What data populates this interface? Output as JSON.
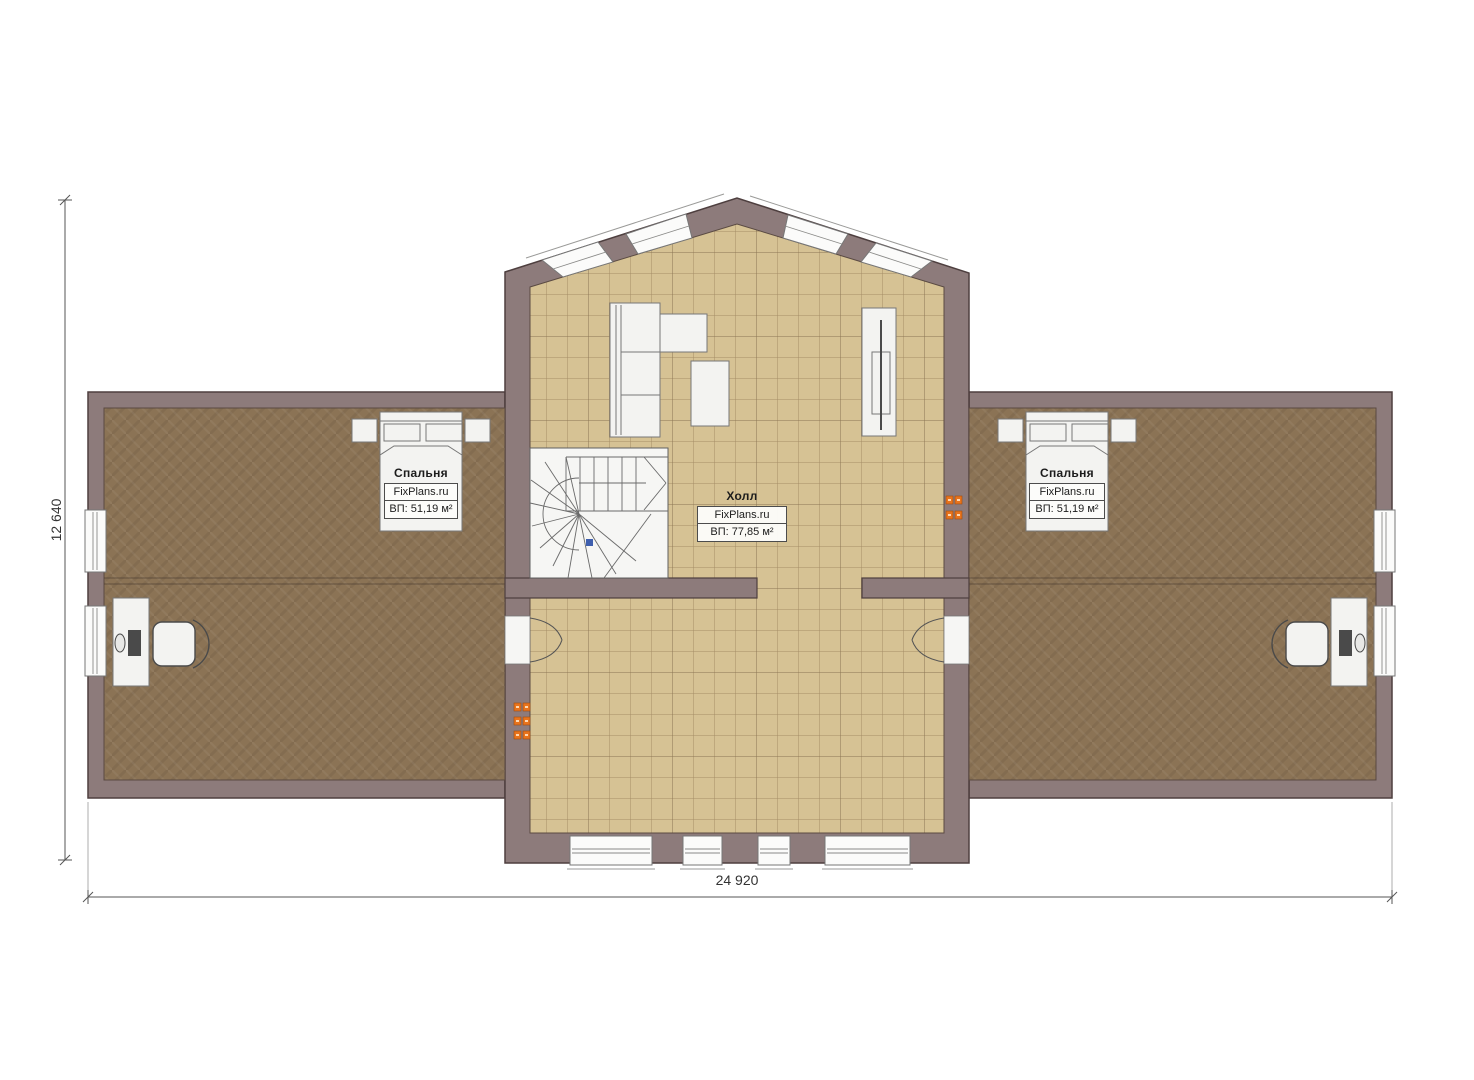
{
  "plan": {
    "brand": "FixPlans.ru",
    "rooms": [
      {
        "name": "Спальня",
        "brand": "FixPlans.ru",
        "area_label": "ВП: 51,19 м²"
      },
      {
        "name": "Холл",
        "brand": "FixPlans.ru",
        "area_label": "ВП: 77,85 м²"
      },
      {
        "name": "Спальня",
        "brand": "FixPlans.ru",
        "area_label": "ВП: 51,19 м²"
      }
    ],
    "dimensions": {
      "width_label": "24 920",
      "height_label": "12 640"
    },
    "colors": {
      "wall": "#8d7b7b",
      "wall_outline": "#4e3f3f",
      "tile_floor": "#d6c294",
      "tile_grid": "#a58d66",
      "carpet_floor": "#8b7355",
      "furniture_white": "#f3f3f1",
      "outlet_orange": "#e8731c",
      "stair_marker_blue": "#3f5fae",
      "dimension_text": "#333333"
    }
  }
}
